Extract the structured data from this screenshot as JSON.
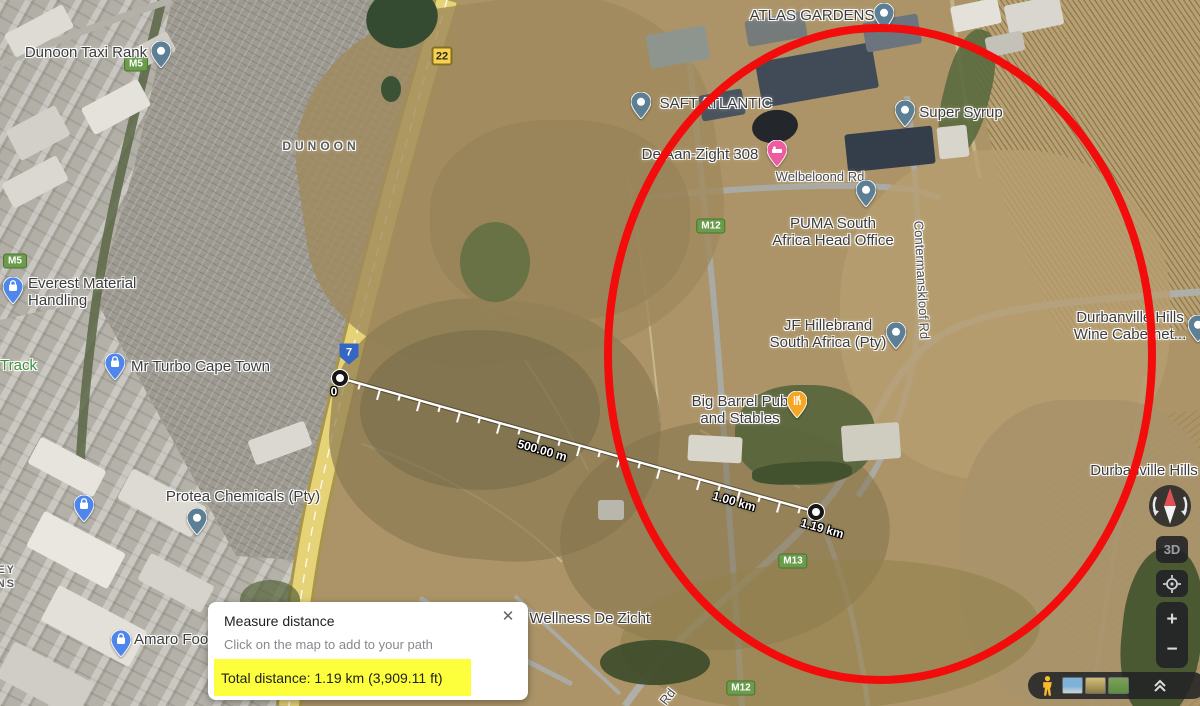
{
  "app": {
    "name": "Google Maps satellite view with measure distance tool"
  },
  "colors": {
    "annotation_red": "#f20c0c",
    "highlight_yellow": "#fdff3d",
    "pin_slate": "#5d7f95",
    "pin_blue": "#4e86ec",
    "pin_pink": "#ec5c9f",
    "pin_orange": "#f5a623",
    "badge_green": "#6b9c4c",
    "shield_blue": "#3566c4"
  },
  "map": {
    "labels": [
      {
        "name": "dunoon-taxi-rank",
        "text": "Dunoon Taxi Rank",
        "x": 86,
        "y": 45,
        "style": "place"
      },
      {
        "name": "area-dunoon",
        "text": "DUNOON",
        "x": 321,
        "y": 140,
        "style": "area"
      },
      {
        "name": "atlas-gardens",
        "text": "ATLAS GARDENS",
        "x": 812,
        "y": 8,
        "style": "place"
      },
      {
        "name": "saft-atlantic",
        "text": "SAFT ATLANTIC",
        "x": 716,
        "y": 96,
        "style": "place"
      },
      {
        "name": "de-aan-zight-308",
        "text": "De Aan-Zight 308",
        "x": 700,
        "y": 147,
        "style": "place"
      },
      {
        "name": "welbeloond-rd",
        "text": "Welbeloond Rd",
        "x": 820,
        "y": 170,
        "style": "road"
      },
      {
        "name": "super-syrup",
        "text": "Super Syrup",
        "x": 961,
        "y": 105,
        "style": "place"
      },
      {
        "name": "puma-head-office",
        "lines": [
          "PUMA South",
          "Africa Head Office"
        ],
        "x": 833,
        "y": 216,
        "style": "place"
      },
      {
        "name": "contermanskloof-rd",
        "text": "Contermanskloof Rd",
        "x": 921,
        "y": 280,
        "style": "road",
        "rot": 87
      },
      {
        "name": "jf-hillebrand",
        "lines": [
          "JF Hillebrand",
          "South Africa (Pty)"
        ],
        "x": 828,
        "y": 318,
        "style": "place"
      },
      {
        "name": "big-barrel-pub",
        "lines": [
          "Big Barrel Pub",
          "and Stables"
        ],
        "x": 740,
        "y": 394,
        "style": "place"
      },
      {
        "name": "durbanville-hills-wine",
        "lines": [
          "Durbanville Hills",
          "Wine Cabernet..."
        ],
        "x": 1130,
        "y": 310,
        "style": "place"
      },
      {
        "name": "durbanville-hills",
        "text": "Durbanville Hills",
        "x": 1144,
        "y": 463,
        "style": "place"
      },
      {
        "name": "everest-material-handling",
        "lines": [
          "Everest Material",
          "Handling"
        ],
        "x": 28,
        "y": 276,
        "style": "place",
        "align": "left"
      },
      {
        "name": "track",
        "text": "Track",
        "x": 0,
        "y": 358,
        "style": "green",
        "align": "left"
      },
      {
        "name": "mr-turbo-cape-town",
        "text": "Mr Turbo Cape Town",
        "x": 131,
        "y": 359,
        "style": "place",
        "align": "left"
      },
      {
        "name": "protea-chemicals",
        "text": "Protea Chemicals (Pty)",
        "x": 243,
        "y": 489,
        "style": "place"
      },
      {
        "name": "killarney-partial",
        "lines": [
          "EY",
          "NS"
        ],
        "x": 16,
        "y": 564,
        "style": "area2",
        "align": "right"
      },
      {
        "name": "amaro-foods",
        "text": "Amaro Foo",
        "x": 134,
        "y": 632,
        "style": "place",
        "align": "left"
      },
      {
        "name": "wellness-de-zicht",
        "text": "a Wellness De Zicht",
        "x": 517,
        "y": 611,
        "style": "place",
        "align": "left"
      },
      {
        "name": "rd-partial",
        "text": "Rd",
        "x": 668,
        "y": 697,
        "style": "road",
        "rot": -52
      }
    ],
    "pins": [
      {
        "name": "pin-dunoon-taxi-rank",
        "x": 161,
        "y": 52,
        "kind": "slate",
        "icon": "circle"
      },
      {
        "name": "pin-atlas-gardens",
        "x": 884,
        "y": 14,
        "kind": "slate",
        "icon": "circle"
      },
      {
        "name": "pin-saft-atlantic",
        "x": 641,
        "y": 103,
        "kind": "slate",
        "icon": "circle"
      },
      {
        "name": "pin-super-syrup",
        "x": 905,
        "y": 111,
        "kind": "slate",
        "icon": "circle"
      },
      {
        "name": "pin-puma",
        "x": 866,
        "y": 191,
        "kind": "slate",
        "icon": "circle"
      },
      {
        "name": "pin-jf-hillebrand",
        "x": 896,
        "y": 333,
        "kind": "slate",
        "icon": "circle"
      },
      {
        "name": "pin-durbanville-wine",
        "x": 1198,
        "y": 326,
        "kind": "slate",
        "icon": "circle"
      },
      {
        "name": "pin-protea-chemicals",
        "x": 197,
        "y": 519,
        "kind": "slate",
        "icon": "circle"
      },
      {
        "name": "pin-everest",
        "x": 13,
        "y": 288,
        "kind": "blue",
        "icon": "bag"
      },
      {
        "name": "pin-mr-turbo",
        "x": 115,
        "y": 364,
        "kind": "blue",
        "icon": "bag"
      },
      {
        "name": "pin-shop",
        "x": 84,
        "y": 506,
        "kind": "blue",
        "icon": "bag"
      },
      {
        "name": "pin-amaro",
        "x": 121,
        "y": 641,
        "kind": "blue",
        "icon": "bag"
      },
      {
        "name": "pin-de-aan-zight",
        "x": 777,
        "y": 151,
        "kind": "pink",
        "icon": "bed"
      },
      {
        "name": "pin-big-barrel",
        "x": 797,
        "y": 402,
        "kind": "orange",
        "icon": "food"
      }
    ],
    "road_badges": [
      {
        "text": "M5",
        "x": 136,
        "y": 64,
        "kind": "m"
      },
      {
        "text": "M5",
        "x": 15,
        "y": 261,
        "kind": "m"
      },
      {
        "text": "M12",
        "x": 711,
        "y": 226,
        "kind": "m"
      },
      {
        "text": "M12",
        "x": 741,
        "y": 688,
        "kind": "m"
      },
      {
        "text": "M13",
        "x": 793,
        "y": 561,
        "kind": "m"
      },
      {
        "text": "22",
        "x": 442,
        "y": 56,
        "kind": "exit"
      },
      {
        "text": "7",
        "x": 349,
        "y": 354,
        "kind": "shield"
      }
    ],
    "measure": {
      "start": {
        "x": 340,
        "y": 378
      },
      "end": {
        "x": 816,
        "y": 512
      },
      "start_label": "0",
      "tick_interval_m": 50,
      "px_per_m": 0.41554,
      "total_m": 1190,
      "distance_labels": [
        {
          "text": "500.00 m",
          "x": 542,
          "y": 451,
          "rot": 15.75
        },
        {
          "text": "1.00 km",
          "x": 734,
          "y": 502,
          "rot": 15.75
        },
        {
          "text": "1.19 km",
          "x": 822,
          "y": 529,
          "rot": 15.75
        }
      ]
    }
  },
  "dialog": {
    "title": "Measure distance",
    "subtitle": "Click on the map to add to your path",
    "total": "Total distance: 1.19 km (3,909.11 ft)",
    "close_glyph": "✕"
  },
  "controls": {
    "three_d_label": "3D",
    "zoom_in_label": "+",
    "zoom_out_label": "−"
  },
  "annotations": {
    "ellipse": {
      "cx": 880,
      "cy": 354,
      "rx": 272,
      "ry": 326,
      "stroke_width": 8
    },
    "highlight": {
      "x": 214,
      "y": 660,
      "w": 257,
      "h": 37
    }
  }
}
